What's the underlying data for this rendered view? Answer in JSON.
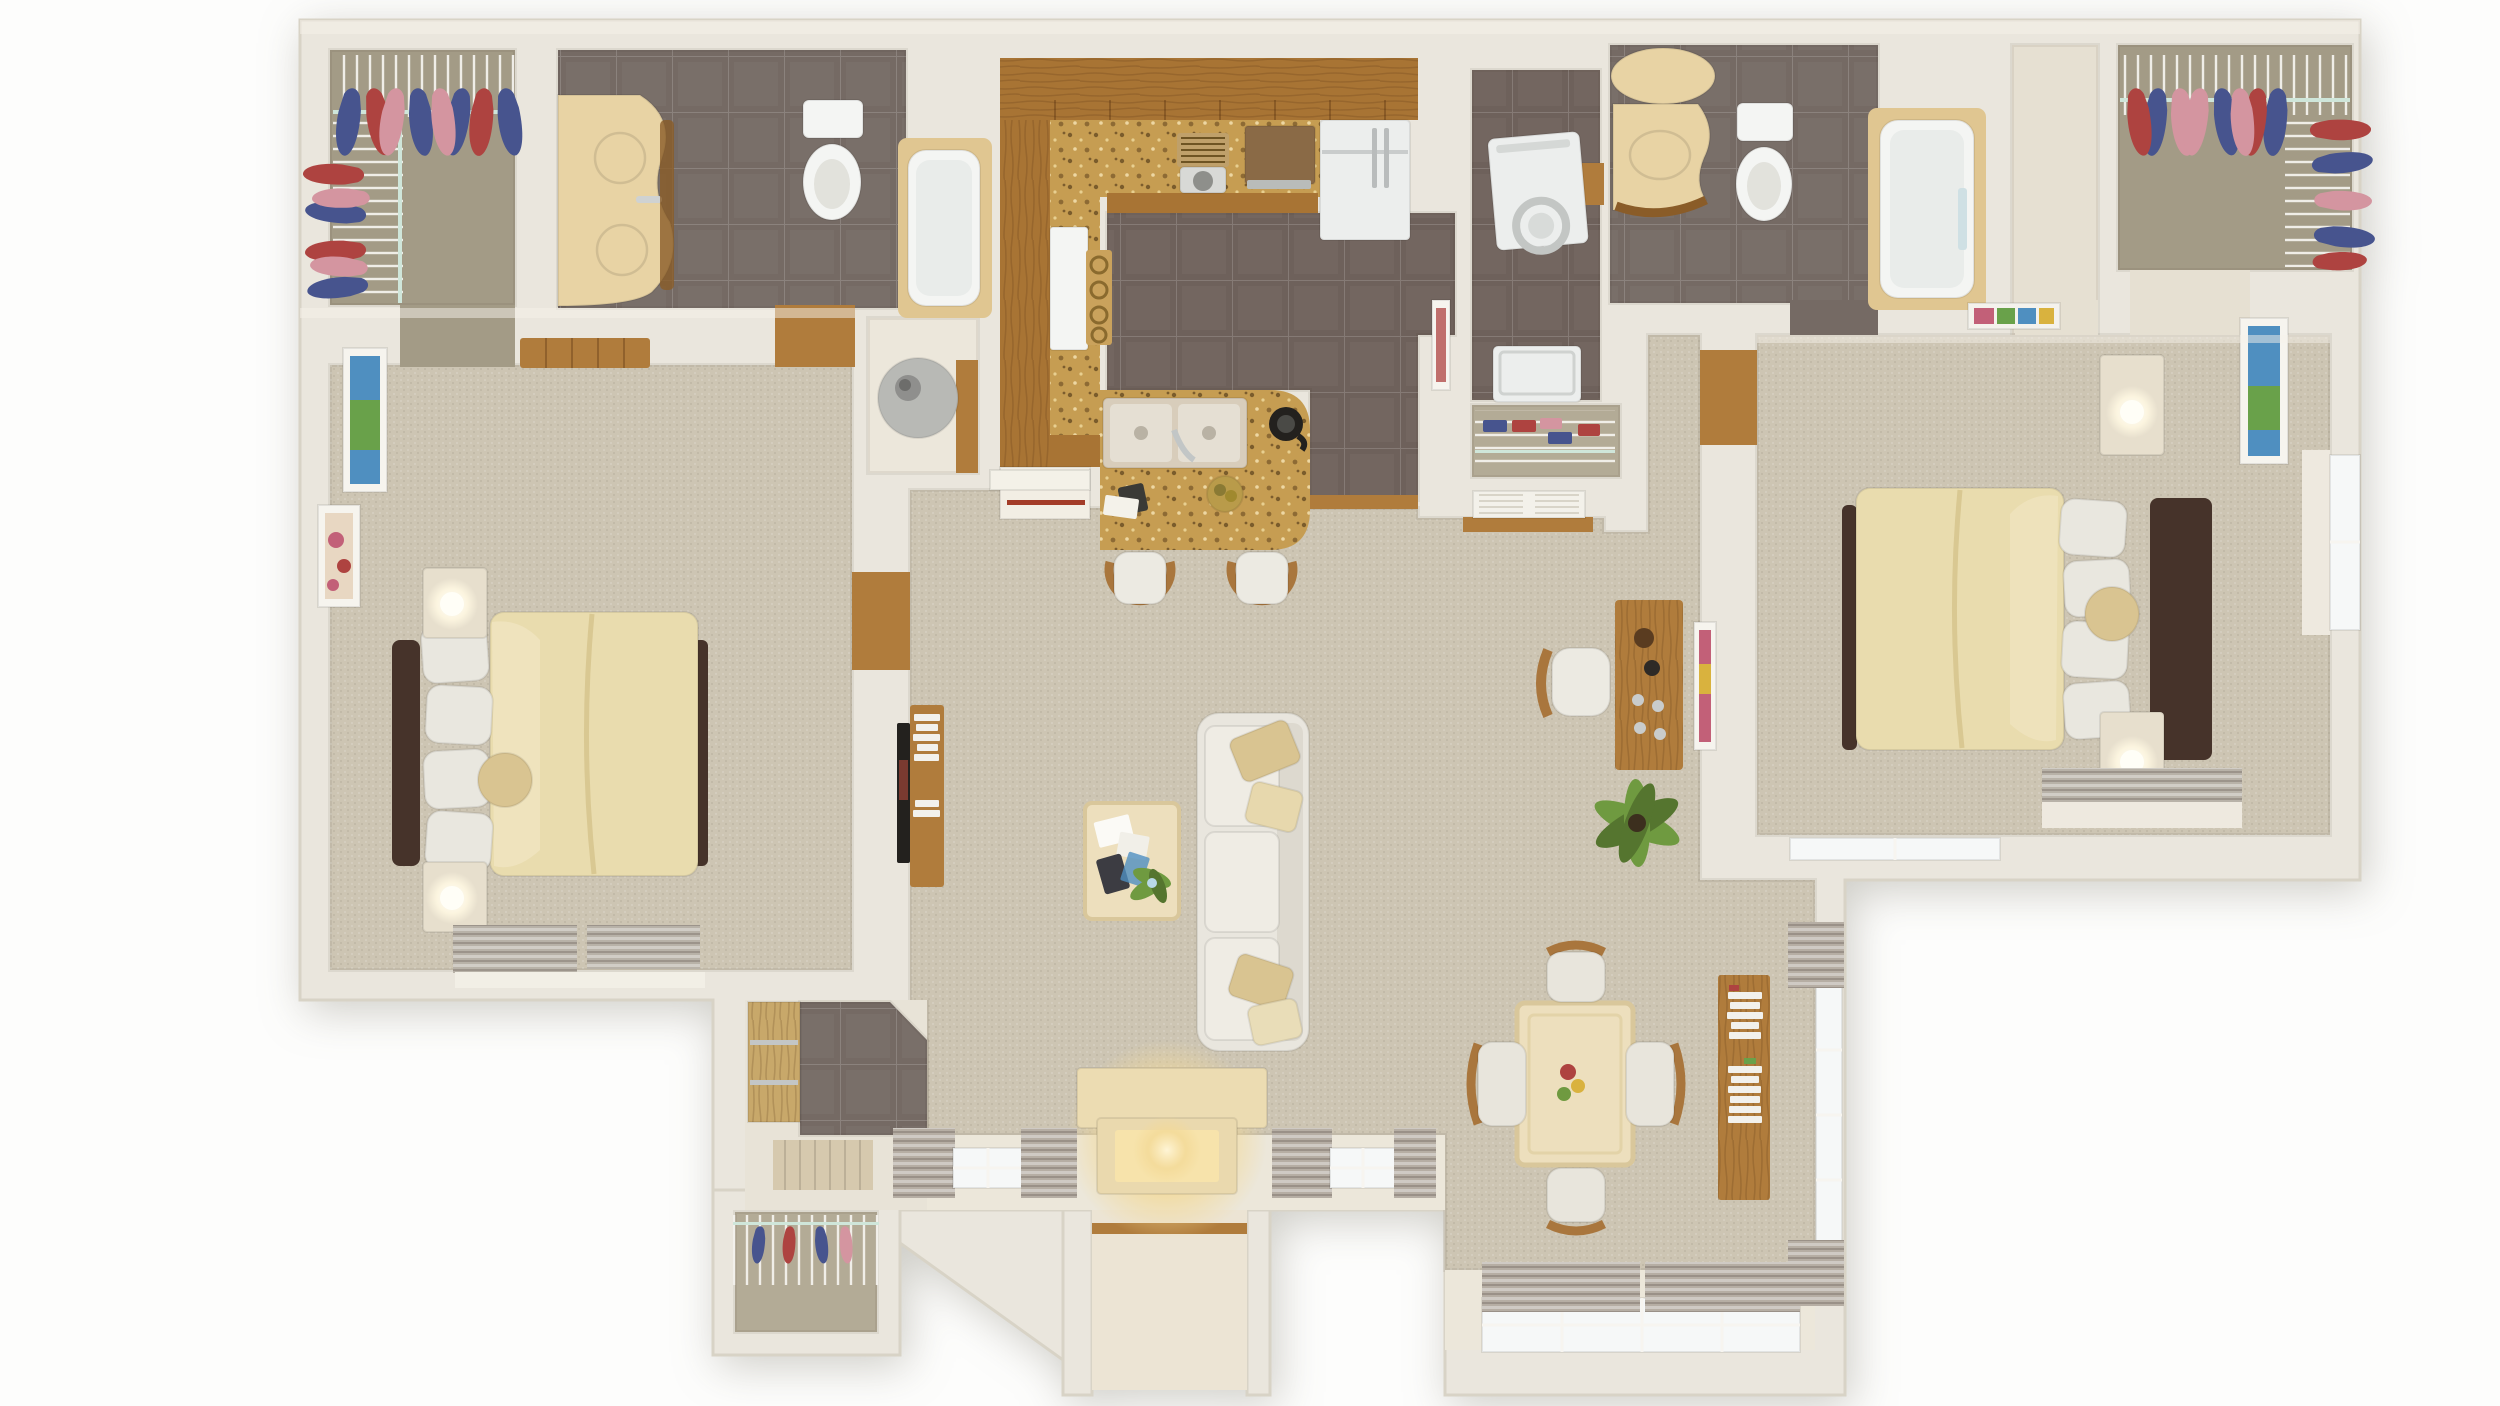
{
  "meta": {
    "title": "Two-bedroom two-bath apartment floor plan, photoreal 3D top-down render",
    "view": "top-down",
    "canvas": {
      "width": 2500,
      "height": 1406
    }
  },
  "palette": {
    "background": "#fdfdfc",
    "wall": "#eae6dd",
    "wall_light": "#f2eee5",
    "sill": "#ece7da",
    "carpet": "#cdc5b3",
    "closet_floor": "#a39b86",
    "linen_floor": "#b3ab96",
    "tile_gray": "#756a64",
    "tile_kitchen": "#6e615b",
    "wood": "#b07c3c",
    "wood_cabinet": "#a87434",
    "wood_dark": "#8a5c28",
    "granite": "#c69d52",
    "counter_cream": "#e8d3a4",
    "tub_surround": "#e0c691",
    "fixture_white": "#f4f5f3",
    "appliance_white": "#eceeed",
    "appliance_gray": "#c9cccc",
    "water_heater": "#b8b9b5",
    "comforter": "#e9dcae",
    "comforter_fold": "#f3e8c6",
    "pillow_white": "#e9e7df",
    "bed_frame": "#46332a",
    "accent_pillow": "#d9c491",
    "nightstand": "#e7dfcd",
    "lamp_glow": "#fffef7",
    "sofa": "#e9e6de",
    "table_cream": "#eddfbd",
    "table_edge": "#dcc99e",
    "curtain": "#b6aea4",
    "blind": "#b8b2a8",
    "glass": "#f6f8f8",
    "glow_warm": "#f7e3ab",
    "fire_marble": "#ecdcb2",
    "plant_green": "#6f9a40",
    "plant_dark": "#55752f",
    "clothes_red": "#ae4340",
    "clothes_pink": "#d495a0",
    "clothes_navy": "#47548e",
    "shelf_rail_mint": "#cfe6da",
    "tv_black": "#23211e",
    "book_white": "#f2f1ec",
    "art_blue": "#4f8fc0",
    "art_green": "#69a14a",
    "art_pink": "#c26078",
    "red_accent": "#a33c28",
    "porch": "#ece4d4",
    "mat_wood": "#d6c9ae",
    "hall_floor": "#e6e0d2",
    "sliding_door_wood": "#c8a86a"
  },
  "rooms": [
    {
      "id": "walkin-closet-left",
      "name": "Walk-in closet (left)",
      "floor": "carpet"
    },
    {
      "id": "bathroom-left",
      "name": "Bathroom 1 (double vanity, toilet, tub)",
      "floor": "gray tile"
    },
    {
      "id": "bedroom-left",
      "name": "Bedroom 1",
      "floor": "carpet"
    },
    {
      "id": "water-heater-closet",
      "name": "Utility closet with water heater",
      "floor": "vinyl"
    },
    {
      "id": "kitchen",
      "name": "Kitchen",
      "floor": "gray tile with oak cabinets and granite counters"
    },
    {
      "id": "laundry",
      "name": "Laundry room (washer and dryer)",
      "floor": "gray tile"
    },
    {
      "id": "linen-closet",
      "name": "Linen closet with louvered doors",
      "floor": "shelving"
    },
    {
      "id": "bathroom-right",
      "name": "Bathroom 2 (vanity, toilet, tub-shower)",
      "floor": "gray tile"
    },
    {
      "id": "hall-right",
      "name": "Bedroom 2 vestibule",
      "floor": "carpet"
    },
    {
      "id": "walkin-closet-right",
      "name": "Walk-in closet (right)",
      "floor": "carpet"
    },
    {
      "id": "bedroom-right",
      "name": "Bedroom 2",
      "floor": "carpet"
    },
    {
      "id": "living-room",
      "name": "Living room",
      "floor": "carpet"
    },
    {
      "id": "dining-room",
      "name": "Dining sunroom",
      "floor": "carpet"
    },
    {
      "id": "foyer",
      "name": "Entry foyer",
      "floor": "gray tile with mat"
    },
    {
      "id": "porch",
      "name": "Entry porch recess",
      "floor": "concrete"
    },
    {
      "id": "coat-closet",
      "name": "Exterior storage closet",
      "floor": "concrete"
    }
  ],
  "furniture": {
    "bedroom_left": [
      "queen bed with cream comforter",
      "two nightstands with lamps",
      "dresser",
      "two wall art frames",
      "double window with blinds"
    ],
    "bathroom_left": [
      "double-sink cream vanity with round mirror",
      "toilet",
      "tub with tile surround"
    ],
    "kitchen": [
      "upper oak cabinet run",
      "granite counter",
      "coffee maker",
      "brown cooktop appliance",
      "french-door refrigerator",
      "white range with grates",
      "granite sink peninsula with double sink, faucet, french press, fruit bowl",
      "two bar stools",
      "half wall with vent"
    ],
    "laundry": [
      "dryer with round door",
      "top-load washer"
    ],
    "linen_closet": [
      "wire shelves with folded towels",
      "louvered double doors"
    ],
    "bathroom_right": [
      "oval mirror and cream vanity",
      "toilet",
      "tub-shower with glass door"
    ],
    "closets": [
      "wire shelving",
      "hanging clothes in red, pink and navy",
      "mint shelf rails"
    ],
    "living_room": [
      "three-seat cream sofa with tan pillows",
      "marble coffee table with magazines and plant",
      "wood media console with books",
      "wall-mounted TV",
      "fireplace with warm glow",
      "two curtained windows",
      "desk with chair and wall art",
      "floor plant"
    ],
    "dining_room": [
      "cream stone dining table",
      "four wood chairs with white cushions",
      "fruit centerpiece",
      "wood bookshelf with books",
      "curtained windows on two walls"
    ],
    "bedroom_right": [
      "queen bed with cream comforter",
      "two nightstands with lamps",
      "wall art",
      "windows with blinds"
    ],
    "entry": [
      "gray tile foyer",
      "wood door mat",
      "sliding-door closet",
      "porch threshold",
      "storage closet with wire shelf and coats"
    ]
  }
}
